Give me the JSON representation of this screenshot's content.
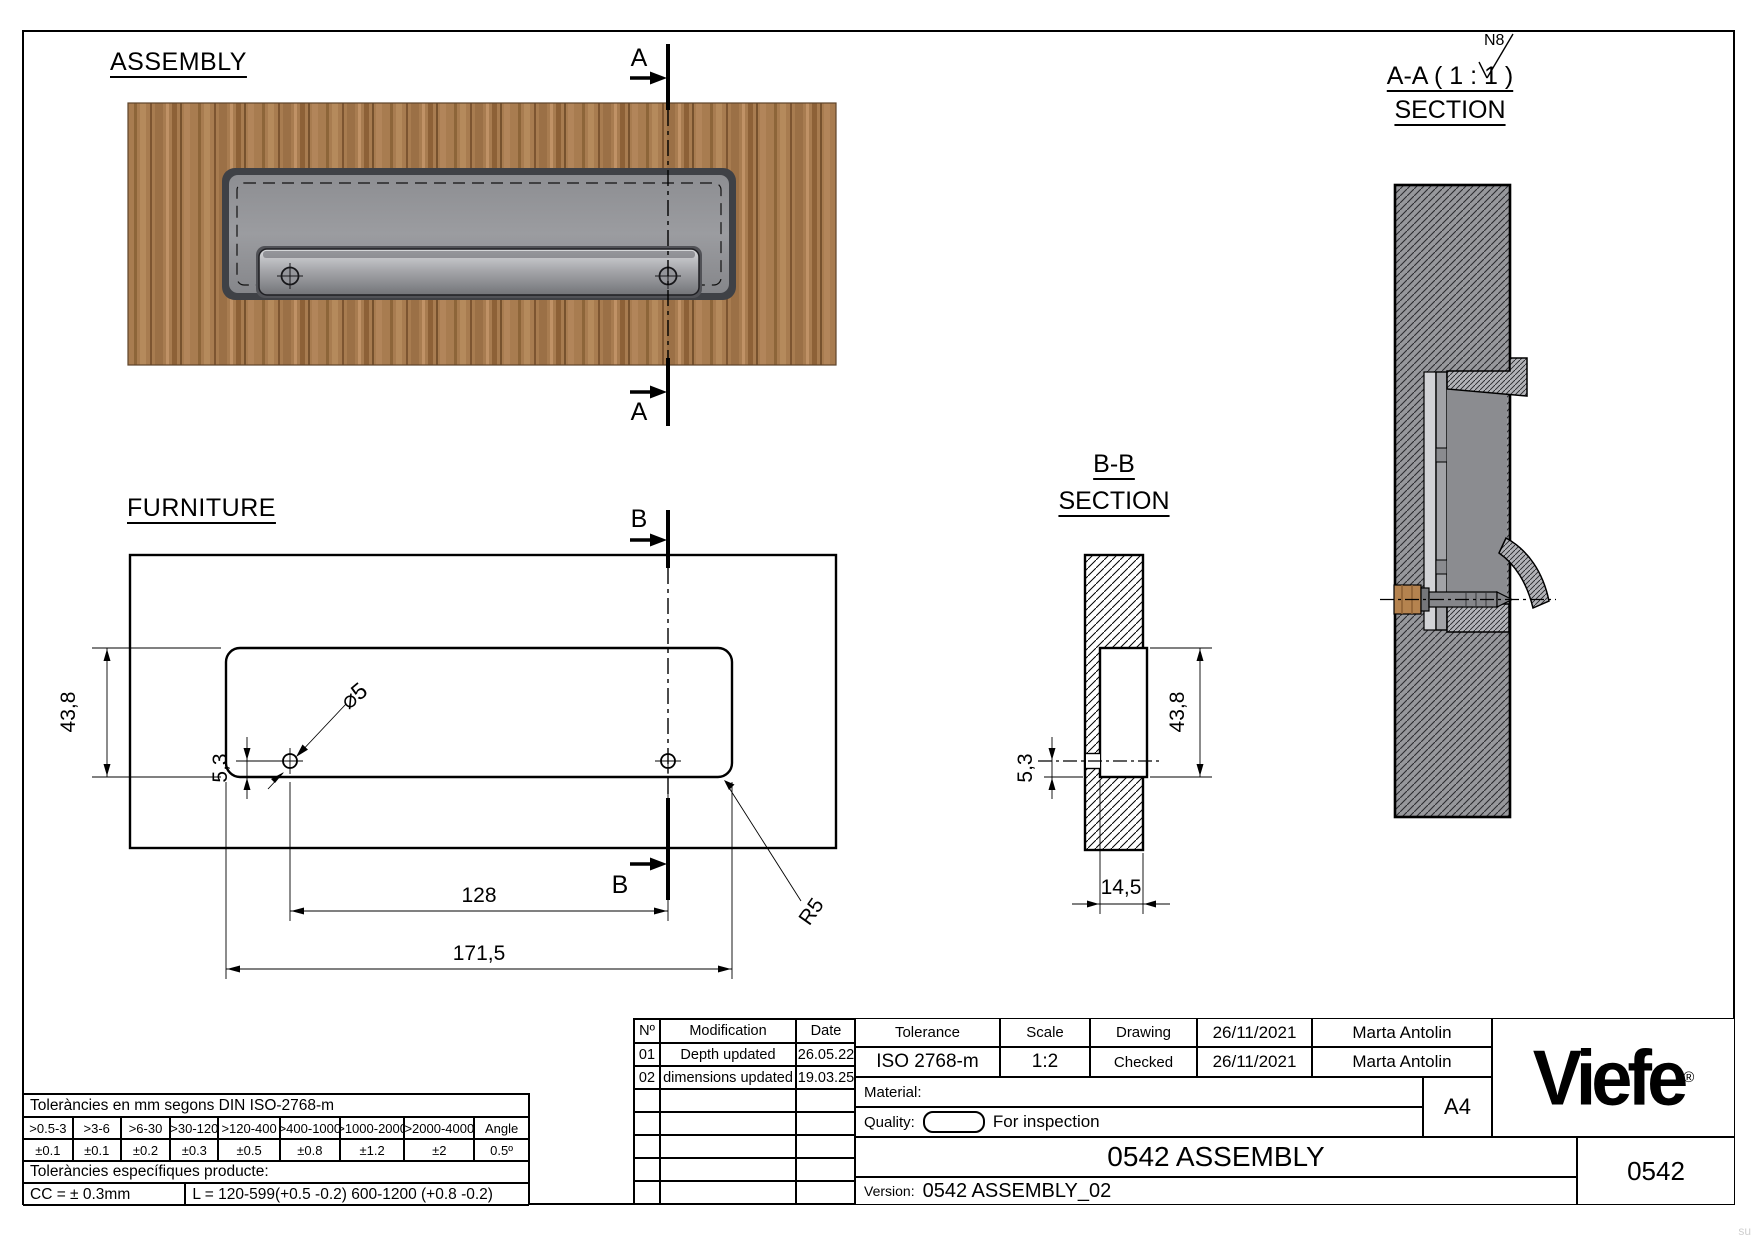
{
  "views": {
    "assembly_label": "ASSEMBLY",
    "furniture_label": "FURNITURE",
    "section_aa_title": "A-A ( 1 : 1 )",
    "section_aa_subtitle": "SECTION",
    "section_bb_title": "B-B",
    "section_bb_subtitle": "SECTION",
    "marker_a": "A",
    "marker_b": "B",
    "surface_finish": "N8",
    "watermark": "su"
  },
  "dimensions": {
    "cutout_height": "43,8",
    "hole_offset": "5,3",
    "hole_diameter": "⌀5",
    "hole_spacing": "128",
    "cutout_length": "171,5",
    "corner_radius": "R5",
    "section_offset": "5,3",
    "section_height": "43,8",
    "section_depth": "14,5"
  },
  "modifications": {
    "headers": [
      "Nº",
      "Modification",
      "Date"
    ],
    "rows": [
      [
        "01",
        "Depth updated",
        "26.05.22"
      ],
      [
        "02",
        "dimensions updated",
        "19.03.25"
      ],
      [
        "",
        "",
        ""
      ],
      [
        "",
        "",
        ""
      ],
      [
        "",
        "",
        ""
      ],
      [
        "",
        "",
        ""
      ],
      [
        "",
        "",
        ""
      ]
    ]
  },
  "titleblock": {
    "tolerance_label": "Tolerance",
    "tolerance_value": "ISO 2768-m",
    "scale_label": "Scale",
    "scale_value": "1:2",
    "drawing_label": "Drawing",
    "drawing_date": "26/11/2021",
    "drawing_author": "Marta Antolin",
    "checked_label": "Checked",
    "checked_date": "26/11/2021",
    "checked_author": "Marta Antolin",
    "material_label": "Material:",
    "quality_label": "Quality:",
    "quality_value": "For inspection",
    "paper_size": "A4",
    "title": "0542 ASSEMBLY",
    "version_label": "Version:",
    "version_value": "0542 ASSEMBLY_02",
    "drawing_number": "0542",
    "logo_text": "Viefe",
    "logo_reg": "®"
  },
  "tolerances": {
    "general_title": "Toleràncies en mm segons DIN ISO-2768-m",
    "ranges": [
      ">0.5-3",
      ">3-6",
      ">6-30",
      ">30-120",
      ">120-400",
      ">400-1000",
      ">1000-2000",
      ">2000-4000",
      "Angle"
    ],
    "values": [
      "±0.1",
      "±0.1",
      "±0.2",
      "±0.3",
      "±0.5",
      "±0.8",
      "±1.2",
      "±2",
      "0.5º"
    ],
    "specific_title": "Toleràncies específiques producte:",
    "cc_tolerance": "CC = ± 0.3mm",
    "length_tolerance": "L = 120-599(+0.5 -0.2) 600-1200 (+0.8 -0.2)"
  }
}
